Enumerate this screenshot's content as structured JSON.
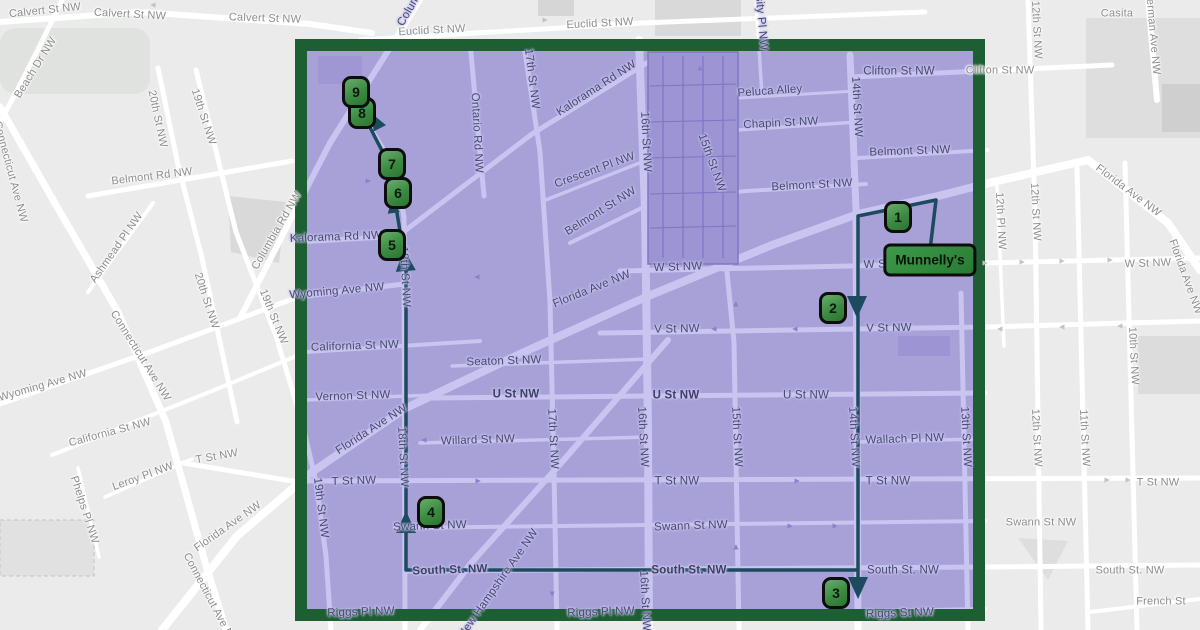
{
  "map": {
    "colors": {
      "background": "#ebebeb",
      "road_outside": "#ffffff",
      "road_inside": "#c9c4f0",
      "region_fill": "#a8a1d8",
      "region_border": "#1e5e33",
      "route": "#1c4a5f",
      "marker_fill_light": "#68ad6b",
      "marker_fill_dark": "#2b7632",
      "marker_border": "#0d0d0d",
      "label_outside": "#8d8d8d",
      "label_inside": "#45496f"
    },
    "poi": {
      "label": "Munnelly's",
      "x": 930,
      "y": 260
    },
    "route_markers": [
      {
        "n": "1",
        "x": 898,
        "y": 217
      },
      {
        "n": "2",
        "x": 833,
        "y": 308
      },
      {
        "n": "3",
        "x": 836,
        "y": 593
      },
      {
        "n": "4",
        "x": 431,
        "y": 512
      },
      {
        "n": "5",
        "x": 392,
        "y": 245
      },
      {
        "n": "6",
        "x": 398,
        "y": 193
      },
      {
        "n": "7",
        "x": 392,
        "y": 164
      },
      {
        "n": "8",
        "x": 362,
        "y": 113
      },
      {
        "n": "9",
        "x": 356,
        "y": 92
      }
    ],
    "street_labels": [
      {
        "text": "Calvert St NW",
        "x": 45,
        "y": 11,
        "rot": -6,
        "zone": "out"
      },
      {
        "text": "Calvert St NW",
        "x": 130,
        "y": 15,
        "rot": 3,
        "zone": "out"
      },
      {
        "text": "Calvert St NW",
        "x": 265,
        "y": 19,
        "rot": 2,
        "zone": "out"
      },
      {
        "text": "Beach Dr NW",
        "x": 36,
        "y": 68,
        "rot": -58,
        "zone": "out"
      },
      {
        "text": "Connecticut Ave NW",
        "x": 10,
        "y": 172,
        "rot": 75,
        "zone": "out"
      },
      {
        "text": "20th St NW",
        "x": 157,
        "y": 119,
        "rot": 78,
        "zone": "out"
      },
      {
        "text": "19th St NW",
        "x": 203,
        "y": 117,
        "rot": 72,
        "zone": "out"
      },
      {
        "text": "Belmont Rd NW",
        "x": 152,
        "y": 177,
        "rot": -7,
        "zone": "out"
      },
      {
        "text": "Ashmead Pl NW",
        "x": 117,
        "y": 248,
        "rot": -55,
        "zone": "out"
      },
      {
        "text": "Columbia Rd NW",
        "x": 277,
        "y": 231,
        "rot": -60,
        "zone": "out"
      },
      {
        "text": "20th St NW",
        "x": 206,
        "y": 301,
        "rot": 72,
        "zone": "out"
      },
      {
        "text": "19th St NW",
        "x": 273,
        "y": 317,
        "rot": 68,
        "zone": "out"
      },
      {
        "text": "Connecticut Ave NW",
        "x": 140,
        "y": 356,
        "rot": 58,
        "zone": "out"
      },
      {
        "text": "Wyoming Ave NW",
        "x": 43,
        "y": 386,
        "rot": -16,
        "zone": "out"
      },
      {
        "text": "California St NW",
        "x": 110,
        "y": 433,
        "rot": -15,
        "zone": "out"
      },
      {
        "text": "Leroy Pl NW",
        "x": 143,
        "y": 477,
        "rot": -20,
        "zone": "out"
      },
      {
        "text": "Phelps Pl NW",
        "x": 84,
        "y": 510,
        "rot": 72,
        "zone": "out"
      },
      {
        "text": "T St NW",
        "x": 217,
        "y": 457,
        "rot": -10,
        "zone": "out"
      },
      {
        "text": "Florida Ave NW",
        "x": 228,
        "y": 527,
        "rot": -35,
        "zone": "out"
      },
      {
        "text": "Connecticut Ave NW",
        "x": 210,
        "y": 600,
        "rot": 62,
        "zone": "out"
      },
      {
        "text": "Casita",
        "x": 1117,
        "y": 14,
        "rot": 0,
        "zone": "out"
      },
      {
        "text": "12th St NW",
        "x": 1036,
        "y": 30,
        "rot": 87,
        "zone": "out"
      },
      {
        "text": "Sherman Ave NW",
        "x": 1152,
        "y": 30,
        "rot": 85,
        "zone": "out"
      },
      {
        "text": "Clifton St NW",
        "x": 1000,
        "y": 71,
        "rot": 0,
        "zone": "out"
      },
      {
        "text": "Florida Ave NW",
        "x": 1128,
        "y": 191,
        "rot": 37,
        "zone": "out"
      },
      {
        "text": "Florida Ave NW",
        "x": 1185,
        "y": 277,
        "rot": 70,
        "zone": "out"
      },
      {
        "text": "12th Pl NW",
        "x": 1000,
        "y": 221,
        "rot": 87,
        "zone": "out"
      },
      {
        "text": "12th St NW",
        "x": 1035,
        "y": 212,
        "rot": 87,
        "zone": "out"
      },
      {
        "text": "W St NW",
        "x": 1148,
        "y": 264,
        "rot": -2,
        "zone": "out"
      },
      {
        "text": "10th St NW",
        "x": 1133,
        "y": 356,
        "rot": 87,
        "zone": "out"
      },
      {
        "text": "12th St NW",
        "x": 1036,
        "y": 438,
        "rot": 87,
        "zone": "out"
      },
      {
        "text": "11th St NW",
        "x": 1084,
        "y": 438,
        "rot": 87,
        "zone": "out"
      },
      {
        "text": "T St NW",
        "x": 1158,
        "y": 483,
        "rot": 0,
        "zone": "out"
      },
      {
        "text": "South St. NW",
        "x": 1130,
        "y": 571,
        "rot": 0,
        "zone": "out"
      },
      {
        "text": "French St",
        "x": 1161,
        "y": 602,
        "rot": 0,
        "zone": "out"
      },
      {
        "text": "Swann St NW",
        "x": 1041,
        "y": 523,
        "rot": 0,
        "zone": "out"
      },
      {
        "text": "Euclid St NW",
        "x": 432,
        "y": 31,
        "rot": -3,
        "zone": "out"
      },
      {
        "text": "Euclid St NW",
        "x": 600,
        "y": 24,
        "rot": -3,
        "zone": "out"
      },
      {
        "text": "Columbia Rd NW",
        "x": 424,
        "y": -14,
        "rot": -60,
        "zone": "in"
      },
      {
        "text": "Ontario Rd NW",
        "x": 476,
        "y": 133,
        "rot": 87,
        "zone": "in"
      },
      {
        "text": "17th St NW",
        "x": 531,
        "y": 79,
        "rot": 83,
        "zone": "in"
      },
      {
        "text": "Kalorama Rd NW",
        "x": 597,
        "y": 89,
        "rot": -33,
        "zone": "in"
      },
      {
        "text": "16th St NW",
        "x": 645,
        "y": 142,
        "rot": 87,
        "zone": "in"
      },
      {
        "text": "15th St NW",
        "x": 711,
        "y": 163,
        "rot": 70,
        "zone": "in"
      },
      {
        "text": "University Pl NW",
        "x": 759,
        "y": 6,
        "rot": 85,
        "zone": "in"
      },
      {
        "text": "Peluca Alley",
        "x": 770,
        "y": 92,
        "rot": -4,
        "zone": "in"
      },
      {
        "text": "Chapin St NW",
        "x": 781,
        "y": 124,
        "rot": -3,
        "zone": "in"
      },
      {
        "text": "Clifton St NW",
        "x": 899,
        "y": 72,
        "rot": 0,
        "zone": "in"
      },
      {
        "text": "14th St NW",
        "x": 856,
        "y": 107,
        "rot": 87,
        "zone": "in"
      },
      {
        "text": "Belmont St NW",
        "x": 910,
        "y": 152,
        "rot": -2,
        "zone": "in"
      },
      {
        "text": "Belmont St NW",
        "x": 812,
        "y": 186,
        "rot": -3,
        "zone": "in"
      },
      {
        "text": "Belmont St NW",
        "x": 601,
        "y": 212,
        "rot": -32,
        "zone": "in"
      },
      {
        "text": "Crescent Pl NW",
        "x": 595,
        "y": 171,
        "rot": -20,
        "zone": "in"
      },
      {
        "text": "Kalorama Rd NW",
        "x": 336,
        "y": 238,
        "rot": -2,
        "zone": "in"
      },
      {
        "text": "Wyoming Ave NW",
        "x": 337,
        "y": 292,
        "rot": -5,
        "zone": "in"
      },
      {
        "text": "Florida Ave NW",
        "x": 592,
        "y": 290,
        "rot": -22,
        "zone": "in"
      },
      {
        "text": "W St NW",
        "x": 678,
        "y": 268,
        "rot": -2,
        "zone": "in"
      },
      {
        "text": "W St NW",
        "x": 888,
        "y": 265,
        "rot": -2,
        "zone": "in"
      },
      {
        "text": "V St NW",
        "x": 677,
        "y": 330,
        "rot": -1,
        "zone": "in"
      },
      {
        "text": "V St NW",
        "x": 889,
        "y": 329,
        "rot": -1,
        "zone": "in"
      },
      {
        "text": "California St NW",
        "x": 355,
        "y": 347,
        "rot": -2,
        "zone": "in"
      },
      {
        "text": "Seaton St NW",
        "x": 504,
        "y": 362,
        "rot": -2,
        "zone": "in"
      },
      {
        "text": "U St NW",
        "x": 516,
        "y": 395,
        "rot": 0,
        "zone": "in",
        "bold": 1
      },
      {
        "text": "U St NW",
        "x": 676,
        "y": 396,
        "rot": 0,
        "zone": "in",
        "bold": 1
      },
      {
        "text": "U St NW",
        "x": 806,
        "y": 396,
        "rot": 0,
        "zone": "in"
      },
      {
        "text": "Vernon St NW",
        "x": 353,
        "y": 397,
        "rot": -2,
        "zone": "in"
      },
      {
        "text": "Florida Ave NW",
        "x": 372,
        "y": 430,
        "rot": -33,
        "zone": "in"
      },
      {
        "text": "Willard St NW",
        "x": 478,
        "y": 441,
        "rot": -2,
        "zone": "in"
      },
      {
        "text": "Wallach Pl NW",
        "x": 905,
        "y": 440,
        "rot": -2,
        "zone": "in"
      },
      {
        "text": "13th St NW",
        "x": 965,
        "y": 437,
        "rot": 87,
        "zone": "in"
      },
      {
        "text": "15th St NW",
        "x": 736,
        "y": 437,
        "rot": 87,
        "zone": "in"
      },
      {
        "text": "14th St NW",
        "x": 853,
        "y": 437,
        "rot": 87,
        "zone": "in"
      },
      {
        "text": "16th St NW",
        "x": 642,
        "y": 437,
        "rot": 87,
        "zone": "in"
      },
      {
        "text": "17th St NW",
        "x": 552,
        "y": 439,
        "rot": 87,
        "zone": "in"
      },
      {
        "text": "18th St NW",
        "x": 404,
        "y": 277,
        "rot": 87,
        "zone": "in"
      },
      {
        "text": "18th St NW",
        "x": 402,
        "y": 457,
        "rot": 87,
        "zone": "in"
      },
      {
        "text": "19th St NW",
        "x": 320,
        "y": 508,
        "rot": 83,
        "zone": "in"
      },
      {
        "text": "T St NW",
        "x": 354,
        "y": 482,
        "rot": -2,
        "zone": "in"
      },
      {
        "text": "T St NW",
        "x": 677,
        "y": 482,
        "rot": 0,
        "zone": "in"
      },
      {
        "text": "T St NW",
        "x": 888,
        "y": 482,
        "rot": 0,
        "zone": "in"
      },
      {
        "text": "Swann St NW",
        "x": 430,
        "y": 527,
        "rot": -2,
        "zone": "in"
      },
      {
        "text": "Swann St NW",
        "x": 691,
        "y": 527,
        "rot": -2,
        "zone": "in"
      },
      {
        "text": "South St. NW",
        "x": 450,
        "y": 571,
        "rot": -2,
        "zone": "in",
        "bold": 1
      },
      {
        "text": "South St. NW",
        "x": 689,
        "y": 571,
        "rot": 0,
        "zone": "in",
        "bold": 1
      },
      {
        "text": "South St. NW",
        "x": 903,
        "y": 571,
        "rot": 0,
        "zone": "in"
      },
      {
        "text": "New Hampshire Ave NW",
        "x": 499,
        "y": 584,
        "rot": -55,
        "zone": "in"
      },
      {
        "text": "Riggs Pl NW",
        "x": 361,
        "y": 613,
        "rot": -2,
        "zone": "in"
      },
      {
        "text": "Riggs Pl NW",
        "x": 601,
        "y": 613,
        "rot": -2,
        "zone": "in"
      },
      {
        "text": "Riggs St NW",
        "x": 900,
        "y": 614,
        "rot": -2,
        "zone": "in"
      },
      {
        "text": "16th St NW",
        "x": 644,
        "y": 601,
        "rot": 87,
        "zone": "in"
      }
    ],
    "road_arrows": [
      {
        "x": 153,
        "y": 5,
        "r": -90,
        "zone": "out"
      },
      {
        "x": 545,
        "y": 20,
        "r": 90,
        "zone": "out"
      },
      {
        "x": 368,
        "y": 181,
        "r": 90,
        "zone": "in"
      },
      {
        "x": 477,
        "y": 277,
        "r": -90,
        "zone": "in"
      },
      {
        "x": 700,
        "y": 68,
        "r": 0,
        "zone": "in"
      },
      {
        "x": 736,
        "y": 304,
        "r": 0,
        "zone": "in"
      },
      {
        "x": 795,
        "y": 329,
        "r": -90,
        "zone": "in"
      },
      {
        "x": 714,
        "y": 329,
        "r": -90,
        "zone": "in"
      },
      {
        "x": 424,
        "y": 440,
        "r": -90,
        "zone": "in"
      },
      {
        "x": 478,
        "y": 481,
        "r": 90,
        "zone": "in"
      },
      {
        "x": 797,
        "y": 481,
        "r": 90,
        "zone": "in"
      },
      {
        "x": 790,
        "y": 526,
        "r": 90,
        "zone": "in"
      },
      {
        "x": 835,
        "y": 526,
        "r": 90,
        "zone": "in"
      },
      {
        "x": 736,
        "y": 547,
        "r": 0,
        "zone": "in"
      },
      {
        "x": 552,
        "y": 594,
        "r": 180,
        "zone": "in"
      },
      {
        "x": 985,
        "y": 263,
        "r": 90,
        "zone": "out"
      },
      {
        "x": 1022,
        "y": 262,
        "r": 90,
        "zone": "out"
      },
      {
        "x": 1062,
        "y": 261,
        "r": 90,
        "zone": "out"
      },
      {
        "x": 1110,
        "y": 260,
        "r": 90,
        "zone": "out"
      },
      {
        "x": 1000,
        "y": 329,
        "r": -90,
        "zone": "out"
      },
      {
        "x": 1062,
        "y": 327,
        "r": -90,
        "zone": "out"
      },
      {
        "x": 1120,
        "y": 326,
        "r": -90,
        "zone": "out"
      },
      {
        "x": 1107,
        "y": 480,
        "r": 90,
        "zone": "out"
      },
      {
        "x": 1128,
        "y": 480,
        "r": 90,
        "zone": "out"
      }
    ]
  }
}
